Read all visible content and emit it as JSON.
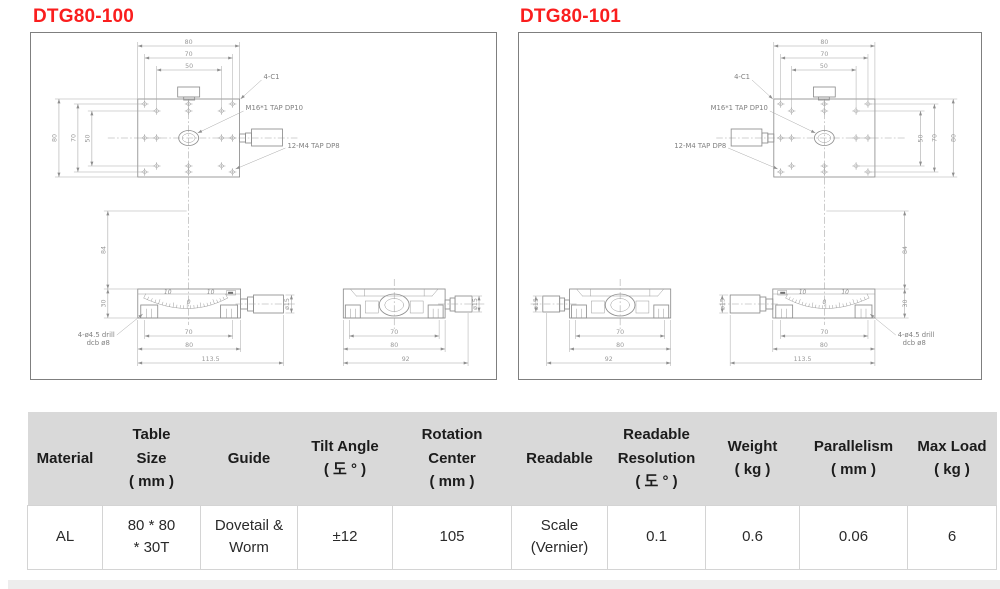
{
  "colors": {
    "accent_red": "#fa1e1e",
    "table_header_bg": "#d9d9d9",
    "footer_band": "#ededed",
    "drawing_line": "#8e8e8e"
  },
  "panels": [
    {
      "title": "DTG80-100",
      "flip": false,
      "labels": {
        "chamfer": "4-C1",
        "center_tap": "M16*1 TAP DP10",
        "hole_tap": "12-M4 TAP DP8",
        "drill_note_1": "4-ø4.5 drill",
        "drill_note_2": "dcb ø8",
        "dim_top": [
          "80",
          "70",
          "50"
        ],
        "dim_side": [
          "80",
          "70",
          "50"
        ],
        "dim_height": "84",
        "dim_body_height": "30",
        "scale_ticks": [
          "10",
          "0",
          "10"
        ],
        "front_bottom_dims": [
          "70",
          "80",
          "113.5"
        ],
        "side_bottom_dims": [
          "70",
          "80",
          "92"
        ],
        "knob_dia": "ø15"
      }
    },
    {
      "title": "DTG80-101",
      "flip": true,
      "labels": {
        "chamfer": "4-C1",
        "center_tap": "M16*1 TAP DP10",
        "hole_tap": "12-M4 TAP DP8",
        "drill_note_1": "4-ø4.5 drill",
        "drill_note_2": "dcb ø8",
        "dim_top": [
          "80",
          "70",
          "50"
        ],
        "dim_side": [
          "80",
          "70",
          "50"
        ],
        "dim_height": "84",
        "dim_body_height": "30",
        "scale_ticks": [
          "10",
          "0",
          "10"
        ],
        "front_bottom_dims": [
          "70",
          "80",
          "113.5"
        ],
        "side_bottom_dims": [
          "70",
          "80",
          "92"
        ],
        "knob_dia": "ø15"
      }
    }
  ],
  "table": {
    "columns": [
      {
        "label": "Material",
        "width": 75
      },
      {
        "label": "Table\nSize\n( mm )",
        "width": 98
      },
      {
        "label": "Guide",
        "width": 97
      },
      {
        "label": "Tilt Angle\n( 도 ° )",
        "width": 95
      },
      {
        "label": "Rotation\nCenter\n( mm )",
        "width": 119
      },
      {
        "label": "Readable",
        "width": 96
      },
      {
        "label": "Readable\nResolution\n( 도 ° )",
        "width": 98
      },
      {
        "label": "Weight\n( kg )",
        "width": 94
      },
      {
        "label": "Parallelism\n( mm )",
        "width": 108
      },
      {
        "label": "Max Load\n( kg )",
        "width": 89
      }
    ],
    "row": [
      "AL",
      "80 * 80\n* 30T",
      "Dovetail &\nWorm",
      "±12",
      "105",
      "Scale\n(Vernier)",
      "0.1",
      "0.6",
      "0.06",
      "6"
    ]
  }
}
